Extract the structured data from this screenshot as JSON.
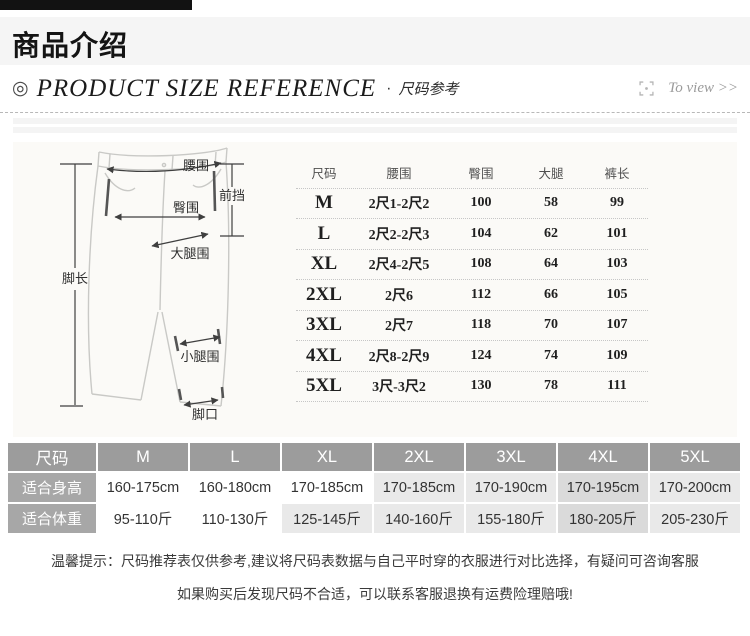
{
  "header": {
    "section_title": "商品介绍",
    "bullet_icon": "◎",
    "title_en": "PRODUCT SIZE REFERENCE",
    "dot": "·",
    "title_cn": "尺码参考",
    "to_view": "To view >>"
  },
  "diagram": {
    "waist": "腰围",
    "front_rise": "前挡",
    "hip": "臀围",
    "thigh": "大腿围",
    "leg_length": "脚长",
    "calf": "小腿围",
    "leg_opening": "脚口"
  },
  "size_table": {
    "headers": [
      "尺码",
      "腰围",
      "臀围",
      "大腿",
      "裤长"
    ],
    "rows": [
      [
        "M",
        "2尺1-2尺2",
        "100",
        "58",
        "99"
      ],
      [
        "L",
        "2尺2-2尺3",
        "104",
        "62",
        "101"
      ],
      [
        "XL",
        "2尺4-2尺5",
        "108",
        "64",
        "103"
      ],
      [
        "2XL",
        "2尺6",
        "112",
        "66",
        "105"
      ],
      [
        "3XL",
        "2尺7",
        "118",
        "70",
        "107"
      ],
      [
        "4XL",
        "2尺8-2尺9",
        "124",
        "74",
        "109"
      ],
      [
        "5XL",
        "3尺-3尺2",
        "130",
        "78",
        "111"
      ]
    ]
  },
  "fit_table": {
    "header": [
      "尺码",
      "M",
      "L",
      "XL",
      "2XL",
      "3XL",
      "4XL",
      "5XL"
    ],
    "height": [
      "适合身高",
      "160-175cm",
      "160-180cm",
      "170-185cm",
      "170-185cm",
      "170-190cm",
      "170-195cm",
      "170-200cm"
    ],
    "weight": [
      "适合体重",
      "95-110斤",
      "110-130斤",
      "125-145斤",
      "140-160斤",
      "155-180斤",
      "180-205斤",
      "205-230斤"
    ]
  },
  "notice": {
    "line1": "温馨提示：尺码推荐表仅供参考,建议将尺码表数据与自己平时穿的衣服进行对比选择，有疑问可咨询客服",
    "line2": "如果购买后发现尺码不合适，可以联系客服退换有运费险理赔哦!"
  },
  "colors": {
    "fit_header_bg": "#9c9c9c",
    "fit_label_bg": "#a7a7a7",
    "cell_gray": "#e9e9e9",
    "cell_dark_gray": "#dadada",
    "chart_bg": "#fbfaf7",
    "band_bg": "#f5f5f5"
  }
}
